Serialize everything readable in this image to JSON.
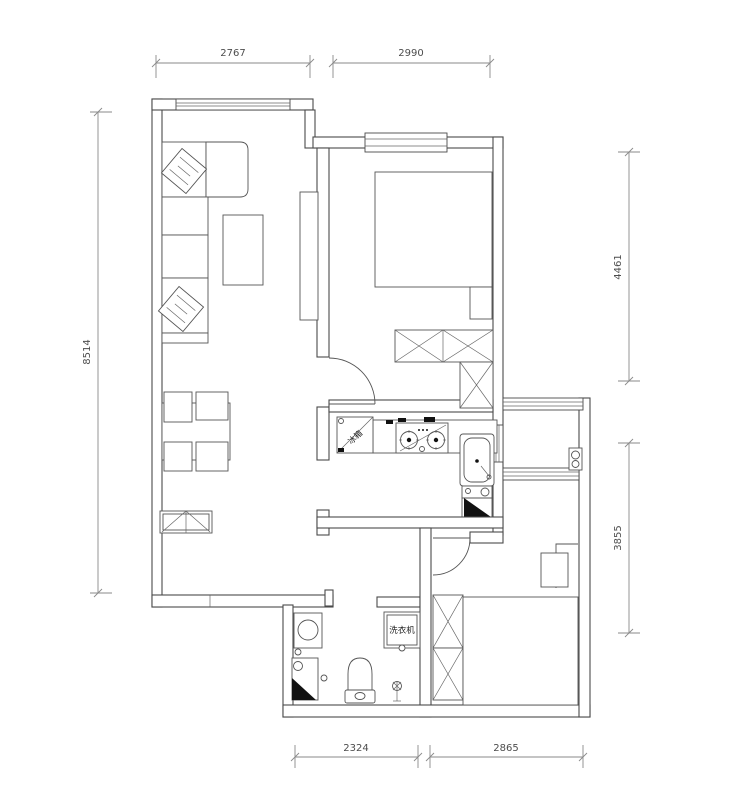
{
  "drawing": {
    "dimensions": {
      "top_left": "2767",
      "top_right": "2990",
      "left_side": "8514",
      "right_upper": "4461",
      "right_lower": "3855",
      "bottom_left": "2324",
      "bottom_right": "2865"
    },
    "appliance_labels": {
      "fridge": "冰箱",
      "washing_machine": "洗衣机"
    },
    "line_color": "#4a4a4a",
    "dimension_color": "#8a8a8a",
    "background": "#ffffff"
  }
}
